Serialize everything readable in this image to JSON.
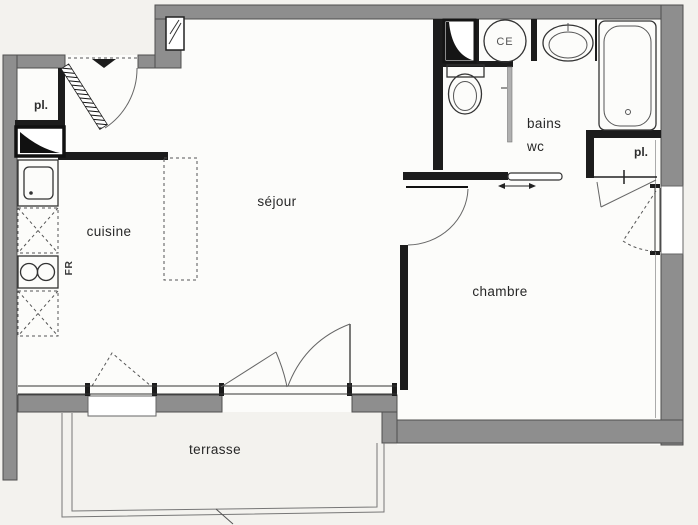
{
  "plan": {
    "rooms": {
      "sejour": "séjour",
      "cuisine": "cuisine",
      "chambre": "chambre",
      "bains": "bains",
      "wc": "wc",
      "terrasse": "terrasse"
    },
    "labels": {
      "closet_entry": "pl.",
      "closet_chambre": "pl.",
      "water_heater": "CE",
      "fridge": "FR"
    },
    "colors": {
      "background": "#f3f2ee",
      "floor": "#fcfcfa",
      "wall_fill": "#8e8e8e",
      "wall_stroke": "#4f4f4f",
      "partition": "#1c1c1c"
    }
  }
}
